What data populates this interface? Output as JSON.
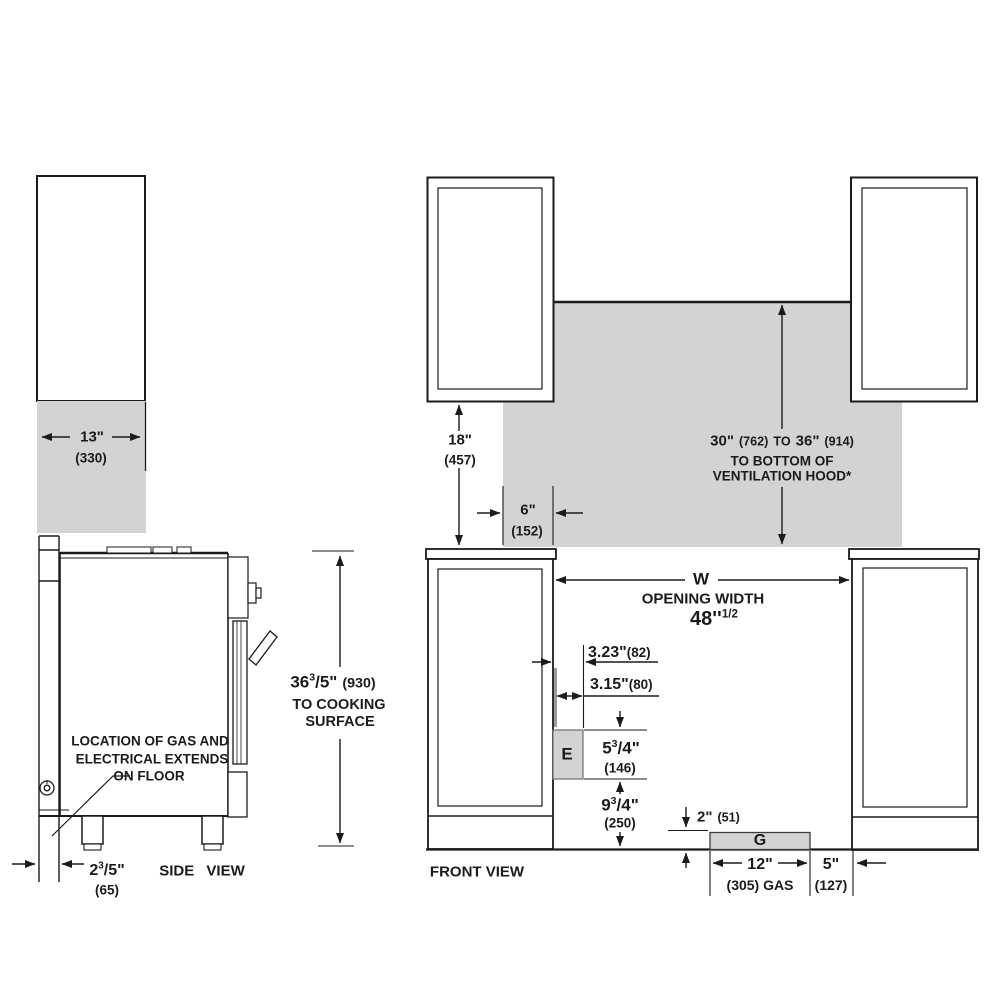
{
  "colors": {
    "line": "#1b1b1b",
    "gray_fill": "#d3d3d3",
    "box_fill": "#d3d3d3"
  },
  "side_view": {
    "label": "SIDE VIEW",
    "cabinet_depth": {
      "value": "13\"",
      "metric": "(330)"
    },
    "counter_height": {
      "whole": "36",
      "sup": "3",
      "denom": "/5\"",
      "metric": "(930)",
      "line2": "TO COOKING",
      "line3": "SURFACE"
    },
    "gas_note": {
      "line1": "LOCATION OF GAS AND",
      "line2": "ELECTRICAL EXTENDS",
      "line3": "ON FLOOR"
    },
    "wall_offset": {
      "whole": "2",
      "sup": "3",
      "denom": "/5\"",
      "metric": "(65)"
    }
  },
  "front_view": {
    "label": "FRONT VIEW",
    "wall_cabinet_height": {
      "value": "18\"",
      "metric": "(457)"
    },
    "hood_clearance": {
      "v1": "30\"",
      "m1": "(762)",
      "to": "TO",
      "v2": "36\"",
      "m2": "(914)",
      "line2": "TO BOTTOM OF",
      "line3": "VENTILATION HOOD*"
    },
    "hood_side_clearance": {
      "value": "6\"",
      "metric": "(152)"
    },
    "opening": {
      "letter": "W",
      "caption": "OPENING WIDTH",
      "value": "48''",
      "sup": "1/2"
    },
    "dim_323": {
      "value": "3.23\"",
      "metric": "(82)"
    },
    "dim_315": {
      "value": "3.15\"",
      "metric": "(80)"
    },
    "electrical_box": "E",
    "dim_e_height": {
      "whole": "5",
      "sup": "3",
      "denom": "/4\"",
      "metric": "(146)"
    },
    "dim_e_floor": {
      "whole": "9",
      "sup": "3",
      "denom": "/4\"",
      "metric": "(250)"
    },
    "dim_gas_height": {
      "value": "2\"",
      "metric": "(51)"
    },
    "gas_box": "G",
    "dim_gas_width": {
      "value": "12\"",
      "metric": "(305) GAS"
    },
    "dim_gas_side": {
      "value": "5\"",
      "metric": "(127)"
    }
  }
}
